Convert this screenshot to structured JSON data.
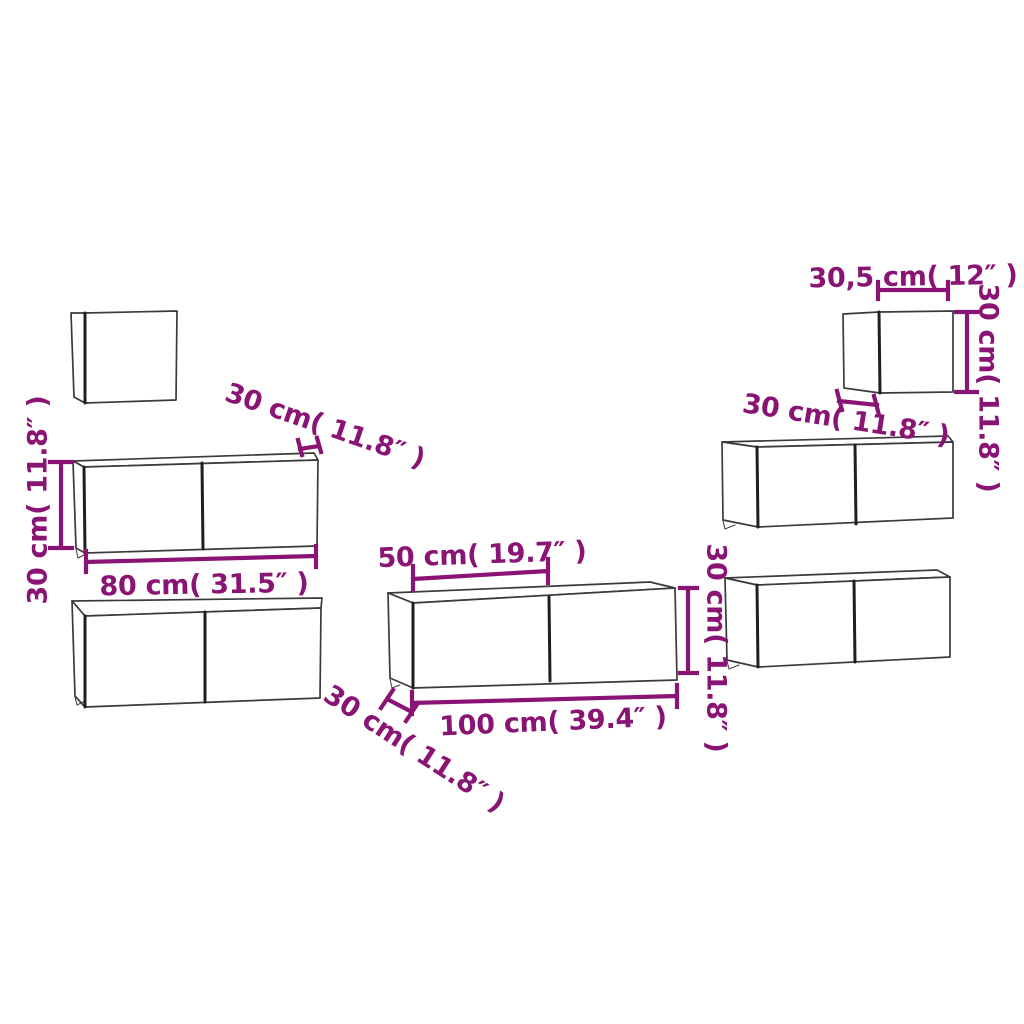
{
  "diagram": {
    "description": "7-piece wall-mounted TV cabinet set dimension drawing",
    "accent_color": "#8A1474",
    "line_color": "#3b3b3b",
    "bold_line_color": "#1f1f1f",
    "background_color": "#ffffff",
    "cabinets": [
      {
        "id": "small-top-left"
      },
      {
        "id": "wide-80cm-upper-left"
      },
      {
        "id": "wide-80cm-lower-left"
      },
      {
        "id": "wide-100cm-center"
      },
      {
        "id": "small-top-right"
      },
      {
        "id": "wide-right-upper"
      },
      {
        "id": "wide-right-lower"
      }
    ],
    "labels": {
      "left_cabinet_height": "30 cm( 11.8″ )",
      "left_cabinet_depth": "30 cm( 11.8″ )",
      "left_cabinet_width": "80 cm( 31.5″ )",
      "center_cabinet_half_width": "50 cm( 19.7″ )",
      "center_cabinet_width": "100 cm( 39.4″ )",
      "center_cabinet_height": "30 cm( 11.8″ )",
      "center_cabinet_depth": "30 cm( 11.8″ )",
      "small_cabinet_width": "30,5 cm( 12″ )",
      "small_cabinet_height": "30 cm( 11.8″ )",
      "small_cabinet_depth": "30 cm( 11.8″ )"
    }
  }
}
